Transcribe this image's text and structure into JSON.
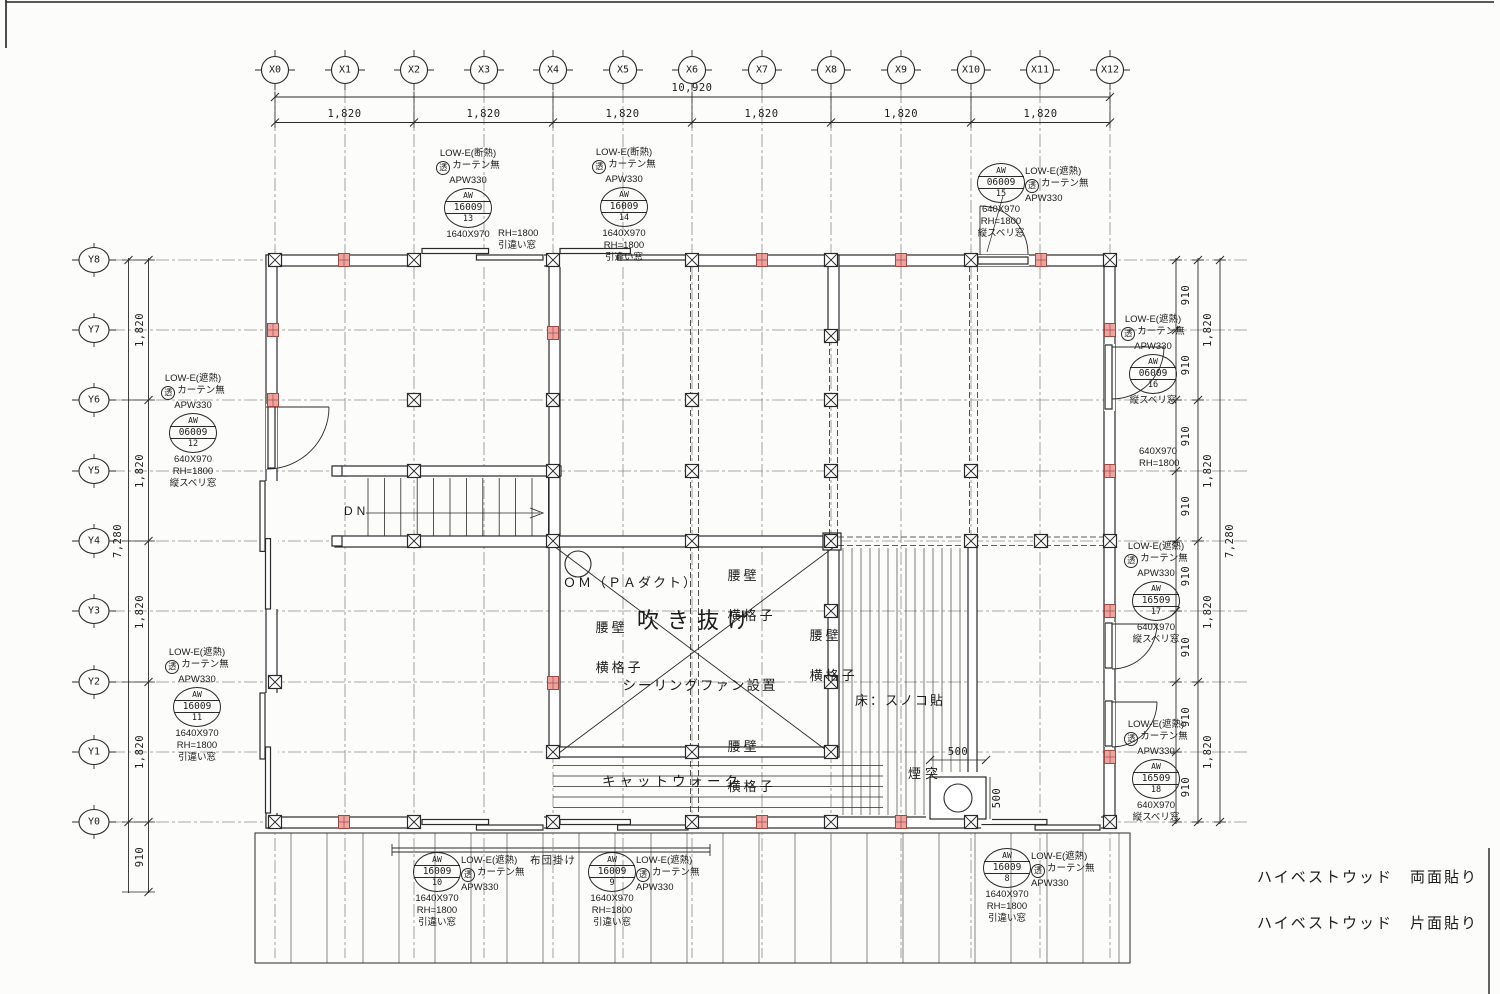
{
  "sheet": {
    "bg": "#fcfcfa",
    "line": "#2a2a2a",
    "grid": "#8a8a8a",
    "red_fill": "#efa3a0",
    "red_border": "#9c4a42"
  },
  "grid": {
    "x_labels": [
      "X0",
      "X1",
      "X2",
      "X3",
      "X4",
      "X5",
      "X6",
      "X7",
      "X8",
      "X9",
      "X10",
      "X11",
      "X12"
    ],
    "y_labels": [
      "Y8",
      "Y7",
      "Y6",
      "Y5",
      "Y4",
      "Y3",
      "Y2",
      "Y1",
      "Y0"
    ]
  },
  "dims": {
    "d10920": "10,920",
    "d1820": "1,820",
    "d910": "910",
    "d7280": "7,280",
    "d500": "500"
  },
  "stair": {
    "dn": "DN"
  },
  "atrium": {
    "void_label": "吹き抜け",
    "om_label": "ＯＭ（ＰＡダクト）",
    "fan_label": "シーリングファン設置",
    "koshikabe": "腰壁",
    "yokogoushi": "横格子"
  },
  "right_zone": {
    "floor_label": "床：スノコ貼",
    "chimney_label": "煙突"
  },
  "bottom_zone": {
    "catwalk_label": "キャットウォーク",
    "futon_label": "布団掛け"
  },
  "notes": {
    "line1": "ハイベストウッド　両面貼り",
    "line2": "ハイベストウッド　片面貼り"
  },
  "notes_extra": [
    {
      "x": 498,
      "y": 228,
      "lines": [
        "RH=1800",
        "引違い窓"
      ]
    },
    {
      "x": 1139,
      "y": 446,
      "lines": [
        "640X970",
        "RH=1800"
      ]
    }
  ],
  "windows": [
    {
      "id": "aw13",
      "x": 468,
      "y": 208,
      "tag": [
        "AW",
        "16009",
        "13"
      ],
      "above": [
        {
          "t": "LOW-E(断熱)"
        },
        {
          "c": "透",
          "t": "カーテン無"
        },
        {
          "t": "APW330"
        }
      ],
      "right": [],
      "below": [
        {
          "t": "1640X970"
        }
      ]
    },
    {
      "id": "aw14",
      "x": 624,
      "y": 207,
      "tag": [
        "AW",
        "16009",
        "14"
      ],
      "above": [
        {
          "t": "LOW-E(断熱)"
        },
        {
          "c": "透",
          "t": "カーテン無"
        },
        {
          "t": "APW330"
        }
      ],
      "right": [],
      "below": [
        {
          "t": "1640X970"
        },
        {
          "t": "RH=1800"
        },
        {
          "t": "引違い窓"
        }
      ]
    },
    {
      "id": "aw15",
      "x": 1001,
      "y": 183,
      "tag": [
        "AW",
        "06009",
        "15"
      ],
      "above": [],
      "right": [
        {
          "t": "LOW-E(遮熱)"
        },
        {
          "c": "透",
          "t": "カーテン無"
        },
        {
          "t": "APW330"
        }
      ],
      "below": [
        {
          "t": "640X970"
        },
        {
          "t": "RH=1800"
        },
        {
          "t": "縦スベリ窓"
        }
      ]
    },
    {
      "id": "aw12",
      "x": 193,
      "y": 433,
      "tag": [
        "AW",
        "06009",
        "12"
      ],
      "above": [
        {
          "t": "LOW-E(遮熱)"
        },
        {
          "c": "透",
          "t": "カーテン無"
        },
        {
          "t": "APW330"
        }
      ],
      "right": [],
      "below": [
        {
          "t": "640X970"
        },
        {
          "t": "RH=1800"
        },
        {
          "t": "縦スベリ窓"
        }
      ]
    },
    {
      "id": "aw11",
      "x": 197,
      "y": 707,
      "tag": [
        "AW",
        "16009",
        "11"
      ],
      "above": [
        {
          "t": "LOW-E(遮熱)"
        },
        {
          "c": "透",
          "t": "カーテン無"
        },
        {
          "t": "APW330"
        }
      ],
      "right": [],
      "below": [
        {
          "t": "1640X970"
        },
        {
          "t": "RH=1800"
        },
        {
          "t": "引違い窓"
        }
      ]
    },
    {
      "id": "aw16",
      "x": 1153,
      "y": 374,
      "tag": [
        "AW",
        "06009",
        "16"
      ],
      "above": [
        {
          "t": "LOW-E(遮熱)"
        },
        {
          "c": "透",
          "t": "カーテン無"
        },
        {
          "t": "APW330"
        }
      ],
      "right": [],
      "below": [
        {
          "t": "縦スベリ窓"
        }
      ]
    },
    {
      "id": "aw17",
      "x": 1156,
      "y": 601,
      "tag": [
        "AW",
        "16509",
        "17"
      ],
      "above": [
        {
          "t": "LOW-E(遮熱)"
        },
        {
          "c": "透",
          "t": "カーテン無"
        },
        {
          "t": "APW330"
        }
      ],
      "right": [],
      "below": [
        {
          "t": "640X970"
        },
        {
          "t": "縦スベリ窓"
        }
      ]
    },
    {
      "id": "aw18",
      "x": 1156,
      "y": 779,
      "tag": [
        "AW",
        "16509",
        "18"
      ],
      "above": [
        {
          "t": "LOW-E(遮熱)"
        },
        {
          "c": "透",
          "t": "カーテン無"
        },
        {
          "t": "APW330"
        }
      ],
      "right": [],
      "below": [
        {
          "t": "640X970"
        },
        {
          "t": "縦スベリ窓"
        }
      ]
    },
    {
      "id": "aw10",
      "x": 437,
      "y": 872,
      "tag": [
        "AW",
        "16009",
        "10"
      ],
      "above": [],
      "right": [
        {
          "t": "LOW-E(遮熱)"
        },
        {
          "c": "透",
          "t": "カーテン無"
        },
        {
          "t": "APW330"
        }
      ],
      "below": [
        {
          "t": "1640X970"
        },
        {
          "t": "RH=1800"
        },
        {
          "t": "引違い窓"
        }
      ]
    },
    {
      "id": "aw9",
      "x": 612,
      "y": 872,
      "tag": [
        "AW",
        "16009",
        "9"
      ],
      "above": [],
      "right": [
        {
          "t": "LOW-E(遮熱)"
        },
        {
          "c": "透",
          "t": "カーテン無"
        },
        {
          "t": "APW330"
        }
      ],
      "below": [
        {
          "t": "1640X970"
        },
        {
          "t": "RH=1800"
        },
        {
          "t": "引違い窓"
        }
      ]
    },
    {
      "id": "aw8",
      "x": 1007,
      "y": 868,
      "tag": [
        "AW",
        "16009",
        "8"
      ],
      "above": [],
      "right": [
        {
          "t": "LOW-E(遮熱)"
        },
        {
          "c": "透",
          "t": "カーテン無"
        },
        {
          "t": "APW330"
        }
      ],
      "below": [
        {
          "t": "1640X970"
        },
        {
          "t": "RH=1800"
        },
        {
          "t": "引違い窓"
        }
      ]
    }
  ]
}
